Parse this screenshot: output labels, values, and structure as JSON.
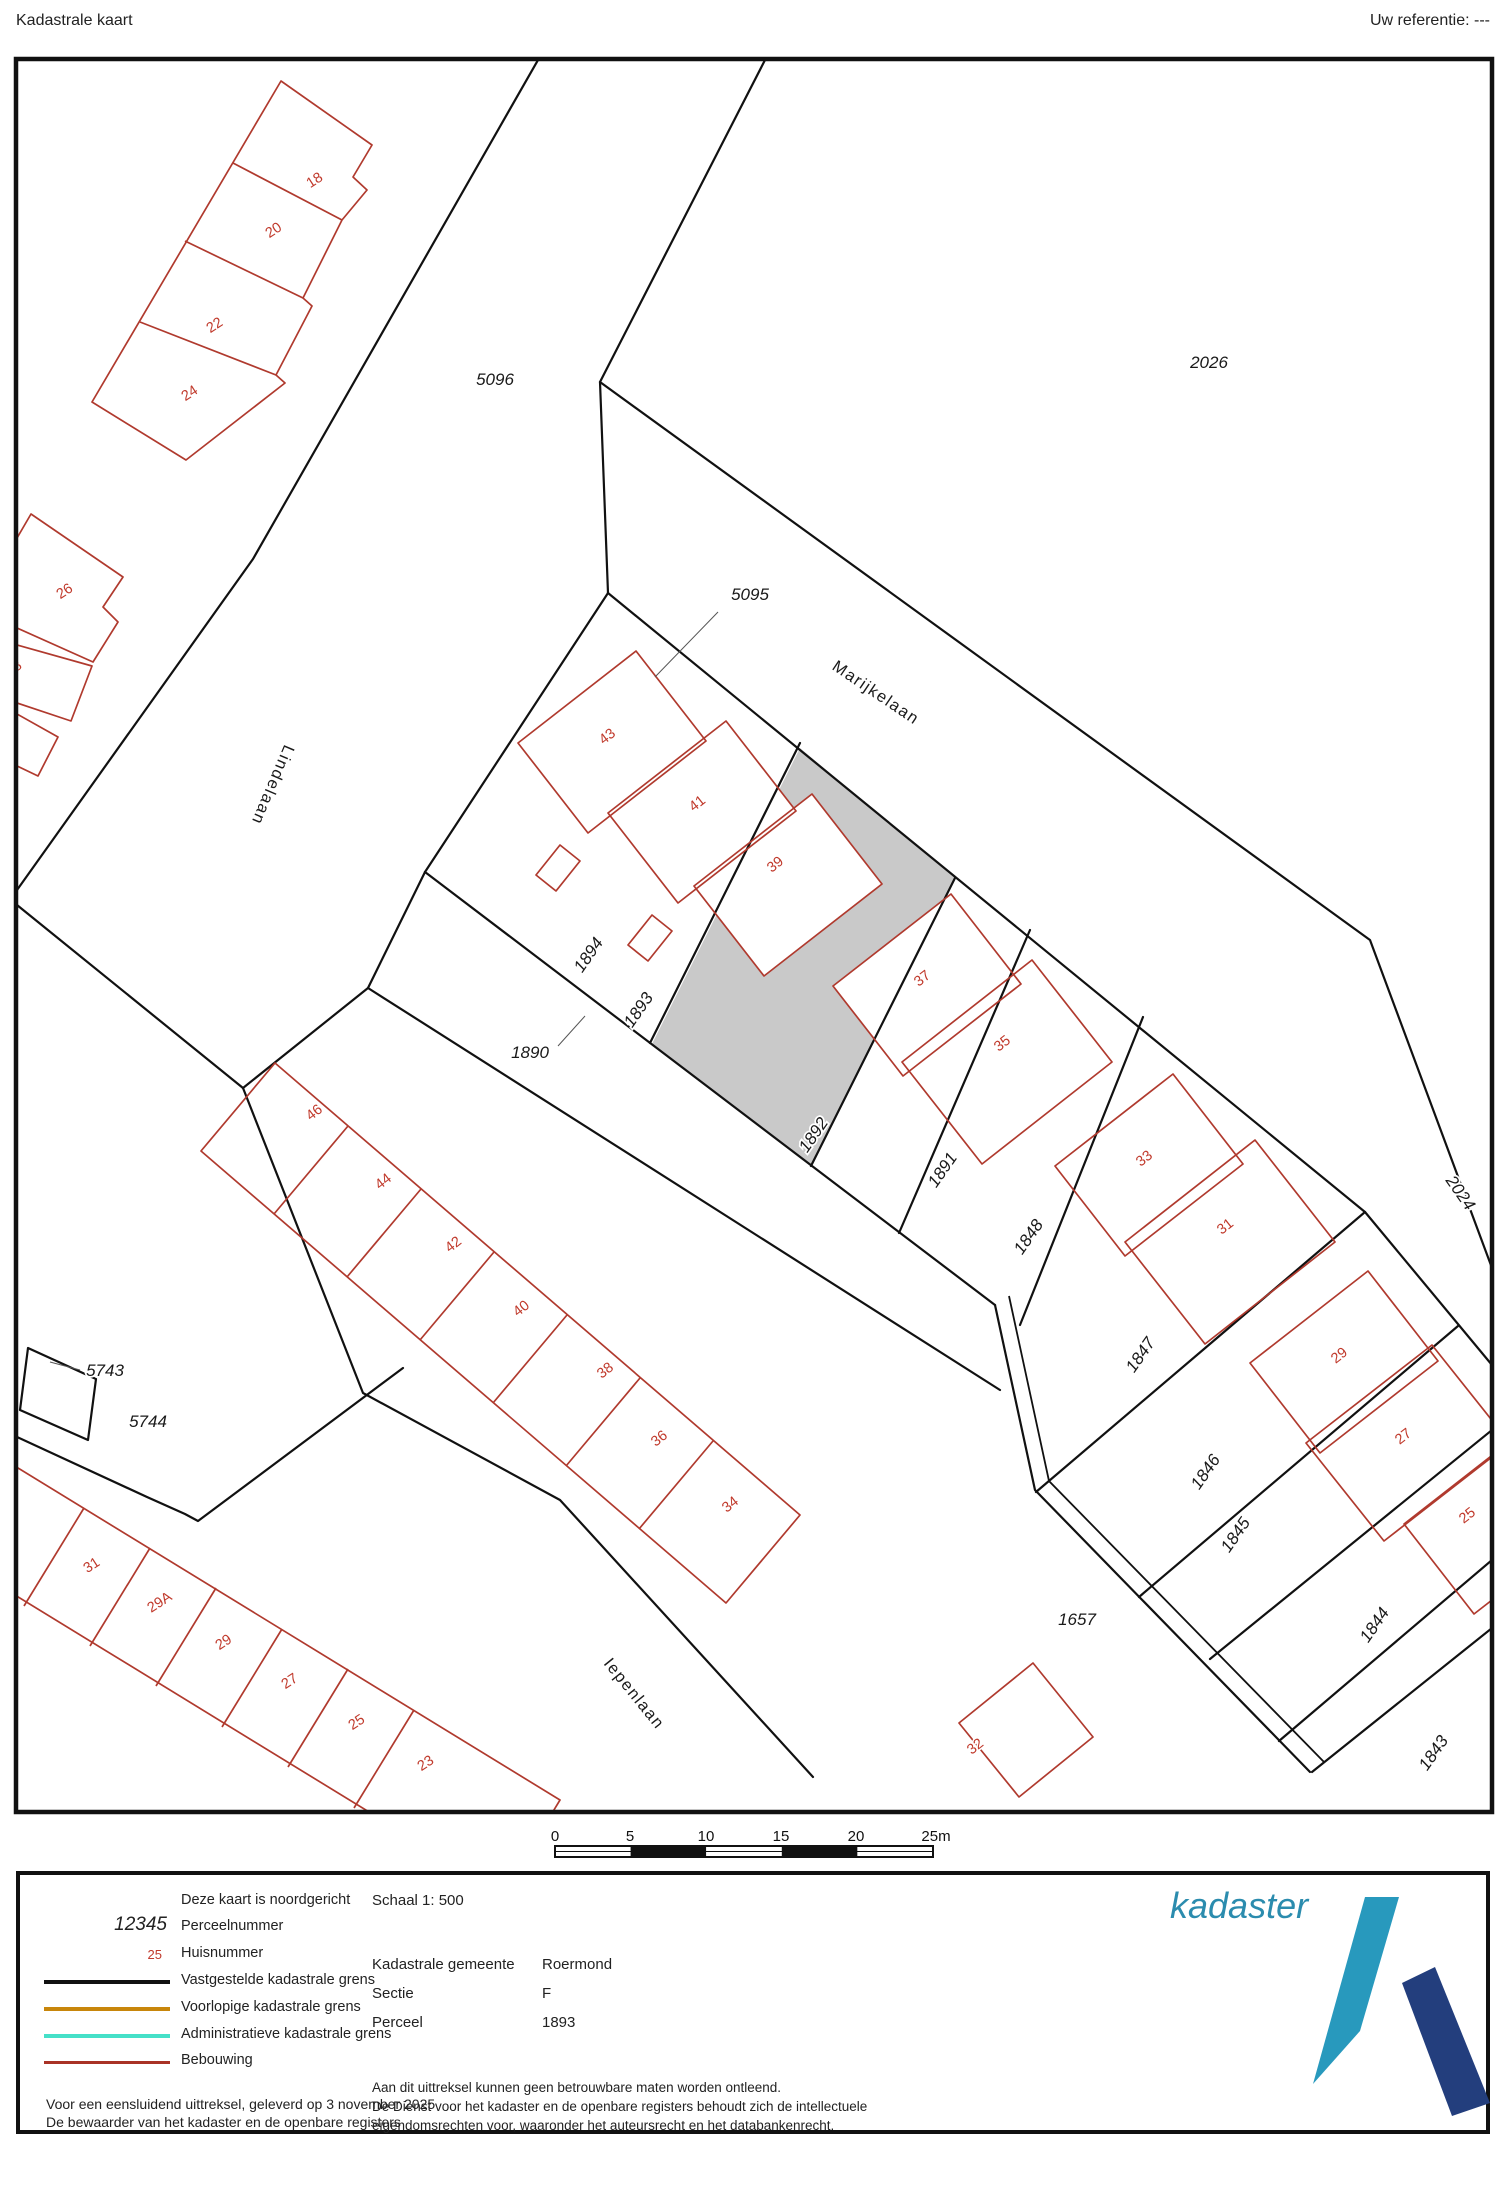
{
  "header": {
    "title": "Kadastrale kaart",
    "reference": "Uw referentie: ---"
  },
  "map": {
    "labels": [
      {
        "t": "5096",
        "x": 495,
        "y": 385,
        "r": 0,
        "k": "p"
      },
      {
        "t": "2026",
        "x": 1209,
        "y": 368,
        "r": 0,
        "k": "p"
      },
      {
        "t": "5095",
        "x": 750,
        "y": 600,
        "r": 0,
        "k": "p"
      },
      {
        "t": "1894",
        "x": 593,
        "y": 958,
        "r": -55,
        "k": "p"
      },
      {
        "t": "1893",
        "x": 643,
        "y": 1013,
        "r": -55,
        "k": "p"
      },
      {
        "t": "1890",
        "x": 530,
        "y": 1058,
        "r": 0,
        "k": "p"
      },
      {
        "t": "1892",
        "x": 818,
        "y": 1138,
        "r": -55,
        "k": "p"
      },
      {
        "t": "1891",
        "x": 947,
        "y": 1173,
        "r": -55,
        "k": "p"
      },
      {
        "t": "1848",
        "x": 1033,
        "y": 1240,
        "r": -55,
        "k": "p"
      },
      {
        "t": "1847",
        "x": 1145,
        "y": 1358,
        "r": -55,
        "k": "p"
      },
      {
        "t": "1846",
        "x": 1210,
        "y": 1475,
        "r": -55,
        "k": "p"
      },
      {
        "t": "1845",
        "x": 1240,
        "y": 1538,
        "r": -55,
        "k": "p"
      },
      {
        "t": "1844",
        "x": 1379,
        "y": 1628,
        "r": -55,
        "k": "p"
      },
      {
        "t": "1843",
        "x": 1438,
        "y": 1756,
        "r": -55,
        "k": "p"
      },
      {
        "t": "2024",
        "x": 1456,
        "y": 1196,
        "r": 55,
        "k": "p"
      },
      {
        "t": "1657",
        "x": 1077,
        "y": 1625,
        "r": 0,
        "k": "p"
      },
      {
        "t": "5743",
        "x": 105,
        "y": 1376,
        "r": 0,
        "k": "p"
      },
      {
        "t": "5744",
        "x": 148,
        "y": 1427,
        "r": 0,
        "k": "p"
      },
      {
        "t": "18",
        "x": 317,
        "y": 184,
        "r": -33,
        "k": "h"
      },
      {
        "t": "20",
        "x": 276,
        "y": 234,
        "r": -33,
        "k": "h"
      },
      {
        "t": "22",
        "x": 217,
        "y": 329,
        "r": -33,
        "k": "h"
      },
      {
        "t": "24",
        "x": 192,
        "y": 397,
        "r": -33,
        "k": "h"
      },
      {
        "t": "26",
        "x": 67,
        "y": 595,
        "r": -33,
        "k": "h"
      },
      {
        "t": "28",
        "x": 16,
        "y": 672,
        "r": -33,
        "k": "h"
      },
      {
        "t": "43",
        "x": 610,
        "y": 740,
        "r": -38,
        "k": "h"
      },
      {
        "t": "41",
        "x": 700,
        "y": 807,
        "r": -38,
        "k": "h"
      },
      {
        "t": "39",
        "x": 778,
        "y": 868,
        "r": -38,
        "k": "h"
      },
      {
        "t": "37",
        "x": 925,
        "y": 982,
        "r": -38,
        "k": "h"
      },
      {
        "t": "35",
        "x": 1005,
        "y": 1047,
        "r": -38,
        "k": "h"
      },
      {
        "t": "33",
        "x": 1147,
        "y": 1162,
        "r": -38,
        "k": "h"
      },
      {
        "t": "31",
        "x": 1228,
        "y": 1230,
        "r": -38,
        "k": "h"
      },
      {
        "t": "29",
        "x": 1342,
        "y": 1359,
        "r": -38,
        "k": "h"
      },
      {
        "t": "27",
        "x": 1406,
        "y": 1440,
        "r": -38,
        "k": "h"
      },
      {
        "t": "25",
        "x": 1470,
        "y": 1519,
        "r": -38,
        "k": "h"
      },
      {
        "t": "46",
        "x": 317,
        "y": 1116,
        "r": -38,
        "k": "h"
      },
      {
        "t": "44",
        "x": 386,
        "y": 1185,
        "r": -38,
        "k": "h"
      },
      {
        "t": "42",
        "x": 456,
        "y": 1248,
        "r": -38,
        "k": "h"
      },
      {
        "t": "40",
        "x": 524,
        "y": 1312,
        "r": -38,
        "k": "h"
      },
      {
        "t": "38",
        "x": 608,
        "y": 1374,
        "r": -38,
        "k": "h"
      },
      {
        "t": "36",
        "x": 662,
        "y": 1442,
        "r": -38,
        "k": "h"
      },
      {
        "t": "34",
        "x": 733,
        "y": 1508,
        "r": -38,
        "k": "h"
      },
      {
        "t": "32",
        "x": 978,
        "y": 1750,
        "r": -38,
        "k": "h"
      },
      {
        "t": "31",
        "x": 94,
        "y": 1569,
        "r": -33,
        "k": "h"
      },
      {
        "t": "29A",
        "x": 162,
        "y": 1606,
        "r": -33,
        "k": "h"
      },
      {
        "t": "29",
        "x": 226,
        "y": 1646,
        "r": -33,
        "k": "h"
      },
      {
        "t": "27",
        "x": 292,
        "y": 1685,
        "r": -33,
        "k": "h"
      },
      {
        "t": "25",
        "x": 359,
        "y": 1726,
        "r": -33,
        "k": "h"
      },
      {
        "t": "23",
        "x": 428,
        "y": 1767,
        "r": -33,
        "k": "h"
      },
      {
        "t": "Lindelaan",
        "x": 268,
        "y": 783,
        "r": 113,
        "k": "s"
      },
      {
        "t": "Marijkelaan",
        "x": 873,
        "y": 697,
        "r": 34,
        "k": "s"
      },
      {
        "t": "Iepenlaan",
        "x": 630,
        "y": 1697,
        "r": 51,
        "k": "s"
      }
    ],
    "leaders": [
      {
        "x1": 718,
        "y1": 612,
        "x2": 655,
        "y2": 677
      },
      {
        "x1": 558,
        "y1": 1046,
        "x2": 585,
        "y2": 1016
      },
      {
        "x1": 80,
        "y1": 1370,
        "x2": 50,
        "y2": 1362
      }
    ]
  },
  "scalebar": {
    "ticks": [
      "0",
      "5",
      "10",
      "15",
      "20",
      "25m"
    ],
    "xs": [
      555,
      630,
      706,
      781,
      856,
      936
    ]
  },
  "legend": {
    "north_note": "Deze kaart is noordgericht",
    "parcel_sample": "12345",
    "parcel_label": "Perceelnummer",
    "house_sample": "25",
    "house_label": "Huisnummer",
    "line1_label": "Vastgestelde kadastrale grens",
    "line1_color": "#111111",
    "line2_label": "Voorlopige kadastrale grens",
    "line2_color": "#c8860b",
    "line3_label": "Administratieve kadastrale grens",
    "line3_color": "#45e0c8",
    "line4_label": "Bebouwing",
    "line4_color": "#a93226",
    "footer_line1": "Voor een eensluidend uittreksel, geleverd op 3 november 2025",
    "footer_line2": "De bewaarder van het kadaster en de openbare registers",
    "schaal": "Schaal 1: 500",
    "gemeente_label": "Kadastrale gemeente",
    "gemeente_value": "Roermond",
    "sectie_label": "Sectie",
    "sectie_value": "F",
    "perceel_label": "Perceel",
    "perceel_value": "1893",
    "disclaimer1": "Aan dit uittreksel kunnen geen betrouwbare maten worden ontleend.",
    "disclaimer2": "De Dienst voor het kadaster en de openbare registers behoudt zich de intellectuele",
    "disclaimer3": "eigendomsrechten voor, waaronder het auteursrecht en het databankenrecht.",
    "logo_text": "kadaster",
    "logo_teal": "#2899bd",
    "logo_navy": "#233e7d"
  }
}
